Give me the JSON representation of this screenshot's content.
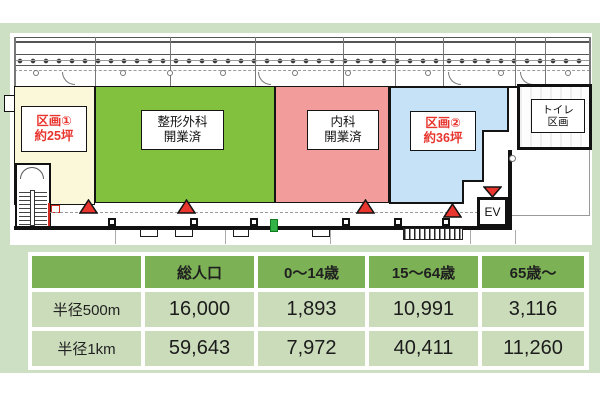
{
  "plan": {
    "regions": [
      {
        "name": "section-1",
        "line1": "区画①",
        "line2": "約25坪",
        "fill": "#fbf7d9",
        "text_color": "#e8352e"
      },
      {
        "name": "orthopedics",
        "line1": "整形外科",
        "line2": "開業済",
        "fill": "#82c13d",
        "text_color": "#1a1a1a"
      },
      {
        "name": "internal-medicine",
        "line1": "内科",
        "line2": "開業済",
        "fill": "#f29c9c",
        "text_color": "#1a1a1a"
      },
      {
        "name": "section-2",
        "line1": "区画②",
        "line2": "約36坪",
        "fill": "#c5e2f6",
        "text_color": "#e8352e"
      },
      {
        "name": "toilet",
        "line1": "トイレ",
        "line2": "区画",
        "fill": "#ffffff",
        "text_color": "#1a1a1a"
      }
    ],
    "elevator_label": "EV",
    "entrance_marker_color": "#e8352e"
  },
  "table": {
    "headers": [
      "",
      "総人口",
      "0〜14歳",
      "15〜64歳",
      "65歳〜"
    ],
    "rows": [
      {
        "label": "半径500m",
        "values": [
          "16,000",
          "1,893",
          "10,991",
          "3,116"
        ]
      },
      {
        "label": "半径1km",
        "values": [
          "59,643",
          "7,972",
          "40,411",
          "11,260"
        ]
      }
    ],
    "colors": {
      "header_bg": "#7cb156",
      "cell_bg": "#cbdcba",
      "panel_bg": "#cde0c3"
    }
  }
}
